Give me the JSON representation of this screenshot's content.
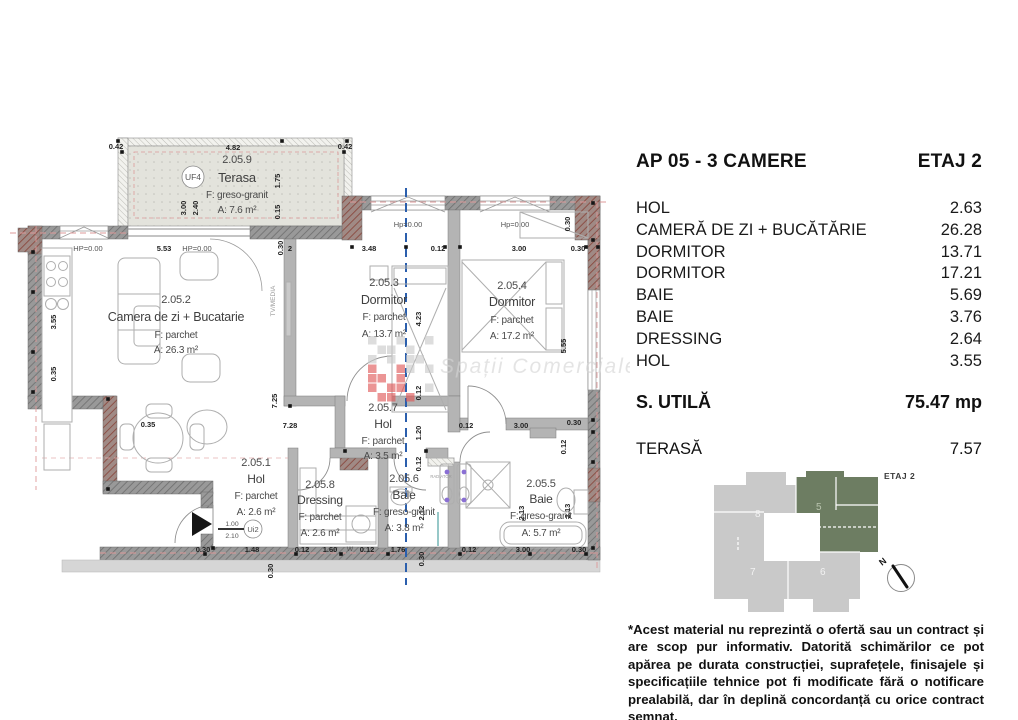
{
  "panel": {
    "title": "AP 05 - 3 CAMERE",
    "floor": "ETAJ 2",
    "rooms": [
      {
        "label": "HOL",
        "value": "2.63"
      },
      {
        "label": "CAMERĂ DE ZI + BUCĂTĂRIE",
        "value": "26.28"
      },
      {
        "label": "DORMITOR",
        "value": "13.71"
      },
      {
        "label": "DORMITOR",
        "value": "17.21"
      },
      {
        "label": "BAIE",
        "value": "5.69"
      },
      {
        "label": "BAIE",
        "value": "3.76"
      },
      {
        "label": "DRESSING",
        "value": "2.64"
      },
      {
        "label": "HOL",
        "value": "3.55"
      }
    ],
    "total": {
      "label": "S. UTILĂ",
      "value": "75.47 mp"
    },
    "terrace": {
      "label": "TERASĂ",
      "value": "7.57"
    },
    "disclaimer": "*Acest material nu reprezintă o ofertă sau un contract și are scop pur informativ. Datorită schimărilor ce pot apărea pe durata construcției, suprafețele, finisajele și specificațiile tehnice pot fi modificate fără o notificare prealabilă, dar în deplină concordanță cu orice contract semnat."
  },
  "minimap": {
    "floor_label": "ETAJ 2",
    "units": [
      {
        "number": "8",
        "highlighted": false
      },
      {
        "number": "5",
        "highlighted": true
      },
      {
        "number": "7",
        "highlighted": false
      },
      {
        "number": "6",
        "highlighted": false
      }
    ],
    "compass": "N",
    "highlight_color": "#6d7d62",
    "base_color": "#c9c9c9"
  },
  "watermark": {
    "text": "Spații Comerciale Cluj"
  },
  "plan": {
    "unit_tag": "UF4",
    "door_tag": "Ui2",
    "rooms": [
      {
        "number": "2.05.9",
        "name": "Terasa",
        "finish": "F: greso-granit",
        "area": "A: 7.6 m²",
        "cx": 237,
        "ys": [
          163,
          182,
          198,
          213
        ],
        "ns": 13
      },
      {
        "number": "2.05.2",
        "name": "Camera de zi + Bucatarie",
        "finish": "F: parchet",
        "area": "A: 26.3 m²",
        "cx": 176,
        "ys": [
          303,
          321,
          338,
          353
        ],
        "ns": 12.5
      },
      {
        "number": "2.05.3",
        "name": "Dormitor",
        "finish": "F: parchet",
        "area": "A: 13.7 m²",
        "cx": 384,
        "ys": [
          286,
          304,
          320,
          337
        ],
        "ns": 12.5
      },
      {
        "number": "2.05.4",
        "name": "Dormitor",
        "finish": "F: parchet",
        "area": "A: 17.2 m²",
        "cx": 512,
        "ys": [
          289,
          306,
          323,
          339
        ],
        "ns": 12.5
      },
      {
        "number": "2.05.7",
        "name": "Hol",
        "finish": "F: parchet",
        "area": "A: 3.5 m²",
        "cx": 383,
        "ys": [
          411,
          428,
          444,
          459
        ],
        "ns": 12
      },
      {
        "number": "2.05.1",
        "name": "Hol",
        "finish": "F: parchet",
        "area": "A: 2.6 m²",
        "cx": 256,
        "ys": [
          466,
          483,
          499,
          515
        ],
        "ns": 12
      },
      {
        "number": "2.05.8",
        "name": "Dressing",
        "finish": "F: parchet",
        "area": "A: 2.6 m²",
        "cx": 320,
        "ys": [
          488,
          504,
          520,
          536
        ],
        "ns": 12
      },
      {
        "number": "2.05.6",
        "name": "Baie",
        "finish": "F: greso-granit",
        "area": "A: 3.8 m²",
        "cx": 404,
        "ys": [
          482,
          499,
          515,
          531
        ],
        "ns": 12
      },
      {
        "number": "2.05.5",
        "name": "Baie",
        "finish": "F: greso-granit",
        "area": "A: 5.7 m²",
        "cx": 541,
        "ys": [
          487,
          503,
          519,
          536
        ],
        "ns": 12
      }
    ],
    "dims": [
      [
        "0.42",
        116,
        149,
        0,
        "b"
      ],
      [
        "4.82",
        233,
        150,
        0,
        "b"
      ],
      [
        "0.42",
        345,
        149,
        0,
        "b"
      ],
      [
        "3.00",
        186,
        208,
        1,
        "b"
      ],
      [
        "2.40",
        198,
        208,
        1,
        "b"
      ],
      [
        "1.75",
        280,
        181,
        1,
        "b"
      ],
      [
        "0.15",
        280,
        212,
        1,
        "b"
      ],
      [
        "HP=0.00",
        88,
        251,
        0,
        "l"
      ],
      [
        "5.53",
        164,
        251,
        0,
        "b"
      ],
      [
        "HP=0.00",
        197,
        251,
        0,
        "l"
      ],
      [
        "0.30",
        283,
        248,
        1,
        "b"
      ],
      [
        "2",
        290,
        251,
        0,
        "b"
      ],
      [
        "3.48",
        369,
        251,
        0,
        "b"
      ],
      [
        "0.12",
        438,
        251,
        0,
        "b"
      ],
      [
        "3.00",
        519,
        251,
        0,
        "b"
      ],
      [
        "0.30",
        578,
        251,
        0,
        "b"
      ],
      [
        "0.30",
        570,
        224,
        1,
        "b"
      ],
      [
        "Hp=0.00",
        408,
        227,
        0,
        "l"
      ],
      [
        "Hp=0.00",
        515,
        227,
        0,
        "l"
      ],
      [
        "3.55",
        56,
        322,
        1,
        "b"
      ],
      [
        "0.35",
        56,
        374,
        1,
        "b"
      ],
      [
        "0.35",
        148,
        427,
        0,
        "b"
      ],
      [
        "7.25",
        277,
        401,
        1,
        "b"
      ],
      [
        "7.28",
        290,
        428,
        0,
        "b"
      ],
      [
        "TV/MEDIA",
        275,
        301,
        1,
        "a"
      ],
      [
        "4.23",
        421,
        319,
        1,
        "b"
      ],
      [
        "0.12",
        421,
        393,
        1,
        "b"
      ],
      [
        "1.20",
        421,
        433,
        1,
        "b"
      ],
      [
        "0.12",
        421,
        464,
        1,
        "b"
      ],
      [
        "2.12",
        424,
        513,
        1,
        "b"
      ],
      [
        "0.12",
        466,
        428,
        0,
        "b"
      ],
      [
        "3.00",
        521,
        428,
        0,
        "b"
      ],
      [
        "0.30",
        574,
        425,
        0,
        "b"
      ],
      [
        "5.55",
        566,
        346,
        1,
        "b"
      ],
      [
        "0.12",
        566,
        447,
        1,
        "b"
      ],
      [
        "2.13",
        570,
        511,
        1,
        "b"
      ],
      [
        "2.13",
        524,
        513,
        1,
        "b"
      ],
      [
        "1.00",
        232,
        526,
        0,
        "s"
      ],
      [
        "2.10",
        232,
        538,
        0,
        "s"
      ],
      [
        "0.30",
        203,
        552,
        0,
        "b"
      ],
      [
        "1.48",
        252,
        552,
        0,
        "b"
      ],
      [
        "0.12",
        302,
        552,
        0,
        "b"
      ],
      [
        "1.60",
        330,
        552,
        0,
        "b"
      ],
      [
        "W",
        350,
        551,
        0,
        "s"
      ],
      [
        "0.12",
        367,
        552,
        0,
        "b"
      ],
      [
        "1.76",
        398,
        552,
        0,
        "b"
      ],
      [
        "0.30",
        424,
        559,
        1,
        "b"
      ],
      [
        "0.12",
        469,
        552,
        0,
        "b"
      ],
      [
        "3.00",
        523,
        552,
        0,
        "b"
      ],
      [
        "0.30",
        579,
        552,
        0,
        "b"
      ],
      [
        "0.30",
        273,
        571,
        1,
        "b"
      ],
      [
        "RADIATOR",
        441,
        478,
        0,
        "t"
      ],
      [
        "RADIATOR",
        500,
        557,
        0,
        "t"
      ]
    ]
  }
}
